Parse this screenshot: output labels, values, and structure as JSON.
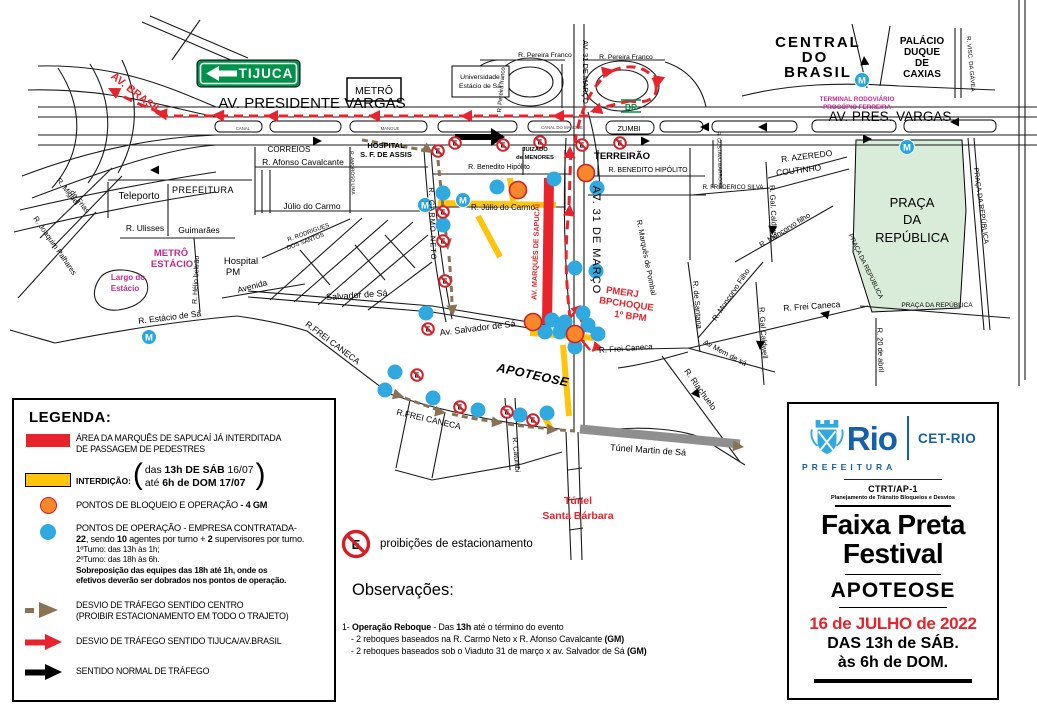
{
  "map": {
    "signs": {
      "tijuca": "TIJUCA",
      "metro_box": "METRÔ",
      "universidade1": "Universidade",
      "universidade2": "Estácio de Sá",
      "br": "BR"
    },
    "icons": {
      "metro": "M",
      "noparking": "E"
    },
    "colors": {
      "red": "#E8232B",
      "yellow": "#FFC40C",
      "orange_dot": "#F6882B",
      "blue_dot": "#2FA9E0",
      "metro_blue": "#28A7DE",
      "magenta": "#C02A90",
      "sign_green": "#00924A",
      "park_green": "#D9EBD9",
      "brown": "#8A7354",
      "tunnel_gray": "#8F8F8F",
      "logo_blue": "#1560A8"
    },
    "labels": [
      {
        "n": "av-brasil",
        "t": "AV. BRASIL",
        "x": 134,
        "y": 96,
        "s": 11,
        "r": 38,
        "c": "#E8232B",
        "w": "bold"
      },
      {
        "n": "av-presidente-vargas",
        "t": "AV. PRESIDENTE VARGAS",
        "x": 312,
        "y": 108,
        "s": 15
      },
      {
        "n": "av-pres-vargas-right",
        "t": "AV.  PRES.  VARGAS",
        "x": 890,
        "y": 121,
        "s": 13.5
      },
      {
        "n": "central-do-brasil-1",
        "t": "CENTRAL",
        "x": 818,
        "y": 47,
        "s": 15,
        "w": "bold",
        "ls": 2
      },
      {
        "n": "central-do-brasil-2",
        "t": "DO",
        "x": 815,
        "y": 62,
        "s": 15,
        "w": "bold",
        "ls": 2
      },
      {
        "n": "central-do-brasil-3",
        "t": "BRASIL",
        "x": 818,
        "y": 77,
        "s": 15,
        "w": "bold",
        "ls": 2
      },
      {
        "n": "palacio-1",
        "t": "PALÁCIO",
        "x": 922,
        "y": 44,
        "s": 10,
        "w": "bold"
      },
      {
        "n": "palacio-2",
        "t": "DUQUE",
        "x": 922,
        "y": 55,
        "s": 10,
        "w": "bold"
      },
      {
        "n": "palacio-3",
        "t": "DE",
        "x": 922,
        "y": 66,
        "s": 10,
        "w": "bold"
      },
      {
        "n": "palacio-4",
        "t": "CAXIAS",
        "x": 922,
        "y": 77,
        "s": 10,
        "w": "bold"
      },
      {
        "n": "visc-gavea",
        "t": "R. VISC. DA GÁVEA",
        "x": 969,
        "y": 64,
        "s": 6,
        "r": 85
      },
      {
        "n": "terminal-1",
        "t": "TERMINAL RODOVIÁRIO",
        "x": 857,
        "y": 101,
        "s": 6.3,
        "w": "bold",
        "c": "#C02A90"
      },
      {
        "n": "terminal-2",
        "t": "PROCÓPIO FERREIRA",
        "x": 857,
        "y": 109,
        "s": 6.3,
        "w": "bold",
        "c": "#C02A90"
      },
      {
        "n": "pereira-franco-1",
        "t": "R. Pereira Franco",
        "x": 545,
        "y": 57,
        "s": 6.8
      },
      {
        "n": "pereira-franco-2",
        "t": "R. Pereira Franco",
        "x": 626,
        "y": 59,
        "s": 6.8
      },
      {
        "n": "pereira-franco-v",
        "t": "R. Pereira franco",
        "x": 503,
        "y": 90,
        "s": 6,
        "r": -85
      },
      {
        "n": "av-31-marco-top",
        "t": "AV.  31  DE  MARÇO",
        "x": 583,
        "y": 72,
        "s": 7.5,
        "r": 90
      },
      {
        "n": "av-31-marco-mid",
        "t": "AV.  31  DE  MARÇO",
        "x": 593,
        "y": 240,
        "s": 11,
        "r": 90,
        "ls": 1
      },
      {
        "n": "zumbi",
        "t": "ZUMBI",
        "x": 629,
        "y": 131,
        "s": 7.5
      },
      {
        "n": "canal-1",
        "t": "CANAL",
        "x": 243,
        "y": 130,
        "s": 4.3,
        "c": "#444"
      },
      {
        "n": "mangue-1",
        "t": "MANGUE",
        "x": 390,
        "y": 130,
        "s": 4.3,
        "c": "#444"
      },
      {
        "n": "canal-2",
        "t": "CANAL  DO  MANGUE",
        "x": 562,
        "y": 129,
        "s": 4.3,
        "c": "#444"
      },
      {
        "n": "correios",
        "t": "CORREIOS",
        "x": 289,
        "y": 152,
        "s": 8
      },
      {
        "n": "afonso-cavalcante",
        "t": "R. Afonso Cavalcante",
        "x": 303,
        "y": 165,
        "s": 8.5
      },
      {
        "n": "hospital-assis-1",
        "t": "HOSPITAL",
        "x": 386,
        "y": 148,
        "s": 7.5,
        "w": "bold"
      },
      {
        "n": "hospital-assis-2",
        "t": "S. F. DE ASSIS",
        "x": 386,
        "y": 157,
        "s": 7.5,
        "w": "bold"
      },
      {
        "n": "juizado-1",
        "t": "JUIZADO",
        "x": 535,
        "y": 151,
        "s": 5.8,
        "w": "bold"
      },
      {
        "n": "juizado-2",
        "t": "de MENORES",
        "x": 535,
        "y": 159,
        "s": 5.8,
        "w": "bold"
      },
      {
        "n": "terreirao",
        "t": "TERREIRÃO",
        "x": 622,
        "y": 159,
        "s": 9.5,
        "w": "bold"
      },
      {
        "n": "benedito-hipolito-e",
        "t": "R. BENEDITO HIPÓLITO",
        "x": 648,
        "y": 172,
        "s": 7
      },
      {
        "n": "benedito-hipolito-w",
        "t": "R. Benedito Hipólito",
        "x": 499,
        "y": 169,
        "s": 7
      },
      {
        "n": "gustavo-barroso",
        "t": "R. GUSTAVO BARROSO",
        "x": 718,
        "y": 160,
        "s": 5,
        "r": 88
      },
      {
        "n": "frederico-silva",
        "t": "R. FREDERICO SILVA",
        "x": 733,
        "y": 189,
        "s": 6
      },
      {
        "n": "azeredo",
        "t": "R. AZEREDO",
        "x": 807,
        "y": 159,
        "s": 8.5,
        "r": -7
      },
      {
        "n": "coutinho",
        "t": "COUTINHO",
        "x": 799,
        "y": 173,
        "s": 8.5,
        "r": -7
      },
      {
        "n": "praca-1",
        "t": "PRAÇA",
        "x": 912,
        "y": 207,
        "s": 13
      },
      {
        "n": "praca-2",
        "t": "DA",
        "x": 912,
        "y": 224,
        "s": 13
      },
      {
        "n": "praca-3",
        "t": "REPÚBLICA",
        "x": 912,
        "y": 242,
        "s": 13
      },
      {
        "n": "praca-street-right",
        "t": "PRAÇA DA REPÚBLICA",
        "x": 979,
        "y": 206,
        "s": 7,
        "r": 82
      },
      {
        "n": "praca-street-inner",
        "t": "PRAÇA DA REPÚBLICA",
        "x": 864,
        "y": 267,
        "s": 6.5,
        "r": 64
      },
      {
        "n": "praca-street-bottom",
        "t": "PRAÇA DA REPÚBLICA",
        "x": 937,
        "y": 307,
        "s": 6.5
      },
      {
        "n": "r-20-abril",
        "t": "R. 20 de abril",
        "x": 878,
        "y": 350,
        "s": 7.5,
        "r": 88
      },
      {
        "n": "gal-caldwell-1",
        "t": "R. Gal. Caldwell",
        "x": 771,
        "y": 212,
        "s": 7.5,
        "r": 87
      },
      {
        "n": "moncorvo-1",
        "t": "R. Moncorvo filho",
        "x": 786,
        "y": 232,
        "s": 7.5,
        "r": -32
      },
      {
        "n": "moncorvo-2",
        "t": "R. Moncorvo Filho",
        "x": 733,
        "y": 296,
        "s": 7.5,
        "r": -56
      },
      {
        "n": "santana",
        "t": "R. de Santana",
        "x": 695,
        "y": 305,
        "s": 7.5,
        "r": 85
      },
      {
        "n": "gal-caldwell-2",
        "t": "R. Gal Caldwell",
        "x": 761,
        "y": 333,
        "s": 7.5,
        "r": 86
      },
      {
        "n": "frei-caneca-e",
        "t": "R. Frei Caneca",
        "x": 812,
        "y": 309,
        "s": 8.5,
        "r": -4
      },
      {
        "n": "mem-de-sa",
        "t": "Av Mem de sá",
        "x": 724,
        "y": 355,
        "s": 7.5,
        "r": 28
      },
      {
        "n": "riachuelo",
        "t": "R. Riachuelo",
        "x": 698,
        "y": 391,
        "s": 8.5,
        "r": 54
      },
      {
        "n": "tunel-martin",
        "t": "Túnel Martin de Sá",
        "x": 648,
        "y": 453,
        "s": 9,
        "r": 4
      },
      {
        "n": "tunel-santa-barbara-1",
        "t": "Túnel",
        "x": 578,
        "y": 504,
        "s": 10.5,
        "w": "bold",
        "c": "#E8232B"
      },
      {
        "n": "tunel-santa-barbara-2",
        "t": "Santa Bárbara",
        "x": 578,
        "y": 519,
        "s": 10.5,
        "w": "bold",
        "c": "#E8232B"
      },
      {
        "n": "catumbi",
        "t": "R. Catumbi",
        "x": 514,
        "y": 455,
        "s": 7,
        "r": 85
      },
      {
        "n": "apoteose",
        "t": "APOTEOSE",
        "x": 532,
        "y": 379,
        "s": 12.5,
        "w": "bold",
        "i": 1,
        "r": 12,
        "ls": 0.5
      },
      {
        "n": "sapucai",
        "t": "AV. MARQUÊS DE SAPUCAÍ",
        "x": 538,
        "y": 252,
        "s": 7.2,
        "w": "bold",
        "c": "#E8232B",
        "r": -88
      },
      {
        "n": "pmerj-1",
        "t": "PMERJ",
        "x": 622,
        "y": 295,
        "s": 9.5,
        "w": "bold",
        "c": "#E8232B",
        "r": 8
      },
      {
        "n": "pmerj-2",
        "t": "BPCHOQUE",
        "x": 626,
        "y": 307,
        "s": 9.5,
        "w": "bold",
        "c": "#E8232B",
        "r": 8
      },
      {
        "n": "pmerj-3",
        "t": "1º BPM",
        "x": 630,
        "y": 319,
        "s": 9.5,
        "w": "bold",
        "c": "#E8232B",
        "r": 8
      },
      {
        "n": "frei-caneca-pmerj",
        "t": "R. Frei Caneca",
        "x": 626,
        "y": 351,
        "s": 8,
        "r": -4
      },
      {
        "n": "carmo-neto",
        "t": "R. CARMO   NETO",
        "x": 430,
        "y": 224,
        "s": 7.5,
        "r": 88,
        "ls": 1
      },
      {
        "n": "amoroso-lima",
        "t": "R. AMOROSO LIMA",
        "x": 351,
        "y": 173,
        "s": 4.8,
        "r": 88
      },
      {
        "n": "julio-carmo-w",
        "t": "Júlio  do  Carmo",
        "x": 312,
        "y": 209,
        "s": 8.5
      },
      {
        "n": "julio-carmo-e",
        "t": "R. Júlio  do  Carmo",
        "x": 503,
        "y": 210,
        "s": 8
      },
      {
        "n": "rodrigues-1",
        "t": "R. RODRIGUES",
        "x": 309,
        "y": 234,
        "s": 6,
        "r": -20
      },
      {
        "n": "rodrigues-2",
        "t": "DOS SANTOS",
        "x": 306,
        "y": 243,
        "s": 6,
        "r": -20
      },
      {
        "n": "salvador-sa",
        "t": "Salvador  de  Sá",
        "x": 357,
        "y": 298,
        "s": 9,
        "r": -4
      },
      {
        "n": "av-salvador-sa",
        "t": "Av. Salvador de Sá",
        "x": 478,
        "y": 331,
        "s": 9,
        "r": -7
      },
      {
        "n": "frei-caneca-w",
        "t": "R.FREI CANECA",
        "x": 331,
        "y": 345,
        "s": 8.5,
        "r": 37
      },
      {
        "n": "frei-caneca-s",
        "t": "R.FREI CANECA",
        "x": 428,
        "y": 422,
        "s": 8.5,
        "r": 13
      },
      {
        "n": "teleporto",
        "t": "Teleporto",
        "x": 139,
        "y": 199,
        "s": 10
      },
      {
        "n": "prefeitura-block",
        "t": "PREFEITURA",
        "x": 203,
        "y": 193,
        "s": 9,
        "ls": 0.5
      },
      {
        "n": "ulisses",
        "t": "R. Ulisses",
        "x": 145,
        "y": 231,
        "s": 8.5
      },
      {
        "n": "guimaraes",
        "t": "Guimarães",
        "x": 199,
        "y": 233,
        "s": 8.5
      },
      {
        "n": "metro-estacio-1",
        "t": "METRÔ",
        "x": 171,
        "y": 256,
        "s": 9.5,
        "w": "bold",
        "c": "#C02A90"
      },
      {
        "n": "metro-estacio-2",
        "t": "ESTÁCIO",
        "x": 172,
        "y": 267,
        "s": 9.5,
        "w": "bold",
        "c": "#C02A90"
      },
      {
        "n": "largo-estacio-1",
        "t": "Largo do",
        "x": 128,
        "y": 280,
        "s": 8,
        "w": "bold",
        "c": "#C02A90"
      },
      {
        "n": "largo-estacio-2",
        "t": "Estácio",
        "x": 125,
        "y": 291,
        "s": 8,
        "w": "bold",
        "c": "#C02A90"
      },
      {
        "n": "helio-beltrao",
        "t": "R. Hélio beltrão",
        "x": 198,
        "y": 280,
        "s": 7,
        "r": -87
      },
      {
        "n": "hospital-pm-1",
        "t": "Hospital",
        "x": 241,
        "y": 264,
        "s": 9.5
      },
      {
        "n": "hospital-pm-2",
        "t": "PM",
        "x": 233,
        "y": 275,
        "s": 9.5
      },
      {
        "n": "avenida",
        "t": "Avenida",
        "x": 253,
        "y": 289,
        "s": 8.5,
        "r": -15
      },
      {
        "n": "estacio-sa",
        "t": "R. Estácio de Sá",
        "x": 170,
        "y": 320,
        "s": 8.5,
        "r": -7
      },
      {
        "n": "miguel-frias-1",
        "t": "R. Miguel",
        "x": 66,
        "y": 193,
        "s": 7.5,
        "r": 52
      },
      {
        "n": "miguel-frias-2",
        "t": "de Frias",
        "x": 78,
        "y": 203,
        "s": 7.5,
        "r": 52
      },
      {
        "n": "joaquim-palhares",
        "t": "R. Joaquim Palhares",
        "x": 53,
        "y": 247,
        "s": 7.5,
        "r": 55
      },
      {
        "n": "marques-pombal",
        "t": "R. Marquês de Pombal",
        "x": 644,
        "y": 258,
        "s": 7.5,
        "r": 79
      }
    ],
    "points": {
      "orange": [
        [
          586,
          173
        ],
        [
          518,
          190
        ],
        [
          533,
          322
        ],
        [
          575,
          334
        ]
      ],
      "blue": [
        [
          443,
          193
        ],
        [
          497,
          187
        ],
        [
          554,
          179
        ],
        [
          597,
          188
        ],
        [
          443,
          225
        ],
        [
          575,
          268
        ],
        [
          596,
          271
        ],
        [
          426,
          313
        ],
        [
          552,
          320
        ],
        [
          565,
          322
        ],
        [
          583,
          313
        ],
        [
          588,
          325
        ],
        [
          598,
          334
        ],
        [
          545,
          332
        ],
        [
          560,
          332
        ],
        [
          575,
          347
        ],
        [
          395,
          372
        ],
        [
          385,
          390
        ],
        [
          433,
          398
        ],
        [
          478,
          410
        ],
        [
          520,
          415
        ],
        [
          547,
          413
        ]
      ]
    },
    "metro_stations": [
      [
        425,
        205
      ],
      [
        463,
        200
      ],
      [
        149,
        337
      ],
      [
        862,
        80
      ],
      [
        907,
        147
      ]
    ],
    "no_parking": [
      [
        438,
        151
      ],
      [
        455,
        143
      ],
      [
        503,
        145
      ],
      [
        540,
        142
      ],
      [
        582,
        145
      ],
      [
        620,
        143
      ],
      [
        443,
        212
      ],
      [
        443,
        241
      ],
      [
        445,
        281
      ],
      [
        428,
        329
      ],
      [
        417,
        375
      ],
      [
        460,
        407
      ],
      [
        507,
        412
      ],
      [
        533,
        420
      ]
    ]
  },
  "legend": {
    "title": "LEGENDA:",
    "area": {
      "l1": "ÁREA DA MARQUÊS DE SAPUCAÍ JÁ INTERDITADA",
      "l2": "DE PASSAGEM DE PEDESTRES"
    },
    "interdicao": {
      "label": "INTERDIÇÃO:",
      "l1a": "das ",
      "l1b": "13h DE SÁB",
      "l1c": " 16/07",
      "l2a": "até ",
      "l2b": "6h de DOM 17/07"
    },
    "bloqueio": {
      "a": "PONTOS DE BLOQUEIO E OPERAÇÃO",
      "b": " - 4 GM"
    },
    "operacao": {
      "l1": "PONTOS DE OPERAÇÃO - EMPRESA CONTRATADA-",
      "l2a": "22",
      "l2b": ", sendo ",
      "l2c": "10",
      "l2d": " agentes por turno + ",
      "l2e": "2",
      "l2f": " supervisores por turno.",
      "l3": "1ºTurno: das 13h às 1h;",
      "l4": "2ºTurno: das 18h às 6h.",
      "l5": "Sobreposição das equipes das 18h até 1h, onde os",
      "l6": "efetivos deverão ser dobrados nos pontos de operação."
    },
    "desvio_centro": {
      "l1": "DESVIO  DE TRÁFEGO SENTIDO CENTRO",
      "l2": "(PROIBIR ESTACIONAMENTO EM TODO O TRAJETO)"
    },
    "desvio_tijuca": "DESVIO  DE TRÁFEGO SENTIDO TIJUCA/AV.BRASIL",
    "normal": "SENTIDO NORMAL  DE TRÁFEGO"
  },
  "observations": {
    "no_parking": "proibições de estacionamento",
    "title": "Observações:",
    "i1a": "1- ",
    "i1b": "Operação Reboque",
    "i1c": " - Das ",
    "i1d": "13h",
    "i1e": "  até o término do evento",
    "i2a": "- 2 reboques baseados na R. Carmo Neto x R. Afonso  Cavalcante ",
    "i2b": "(GM)",
    "i3a": "- 2 reboques baseados sob o Viaduto 31 de março x av. Salvador de Sá ",
    "i3b": "(GM)"
  },
  "info_panel": {
    "rio": "Rio",
    "prefeitura": "PREFEITURA",
    "cet": "CET-RIO",
    "dept": "CTRT/AP-1",
    "dept_sub": "Planejamento de Trânsito Bloqueios e Desvios",
    "title1": "Faixa Preta",
    "title2": "Festival",
    "venue": "APOTEOSE",
    "date": "16 de JULHO de 2022",
    "time1": "DAS 13h de SÁB.",
    "time2": "às 6h de DOM."
  }
}
